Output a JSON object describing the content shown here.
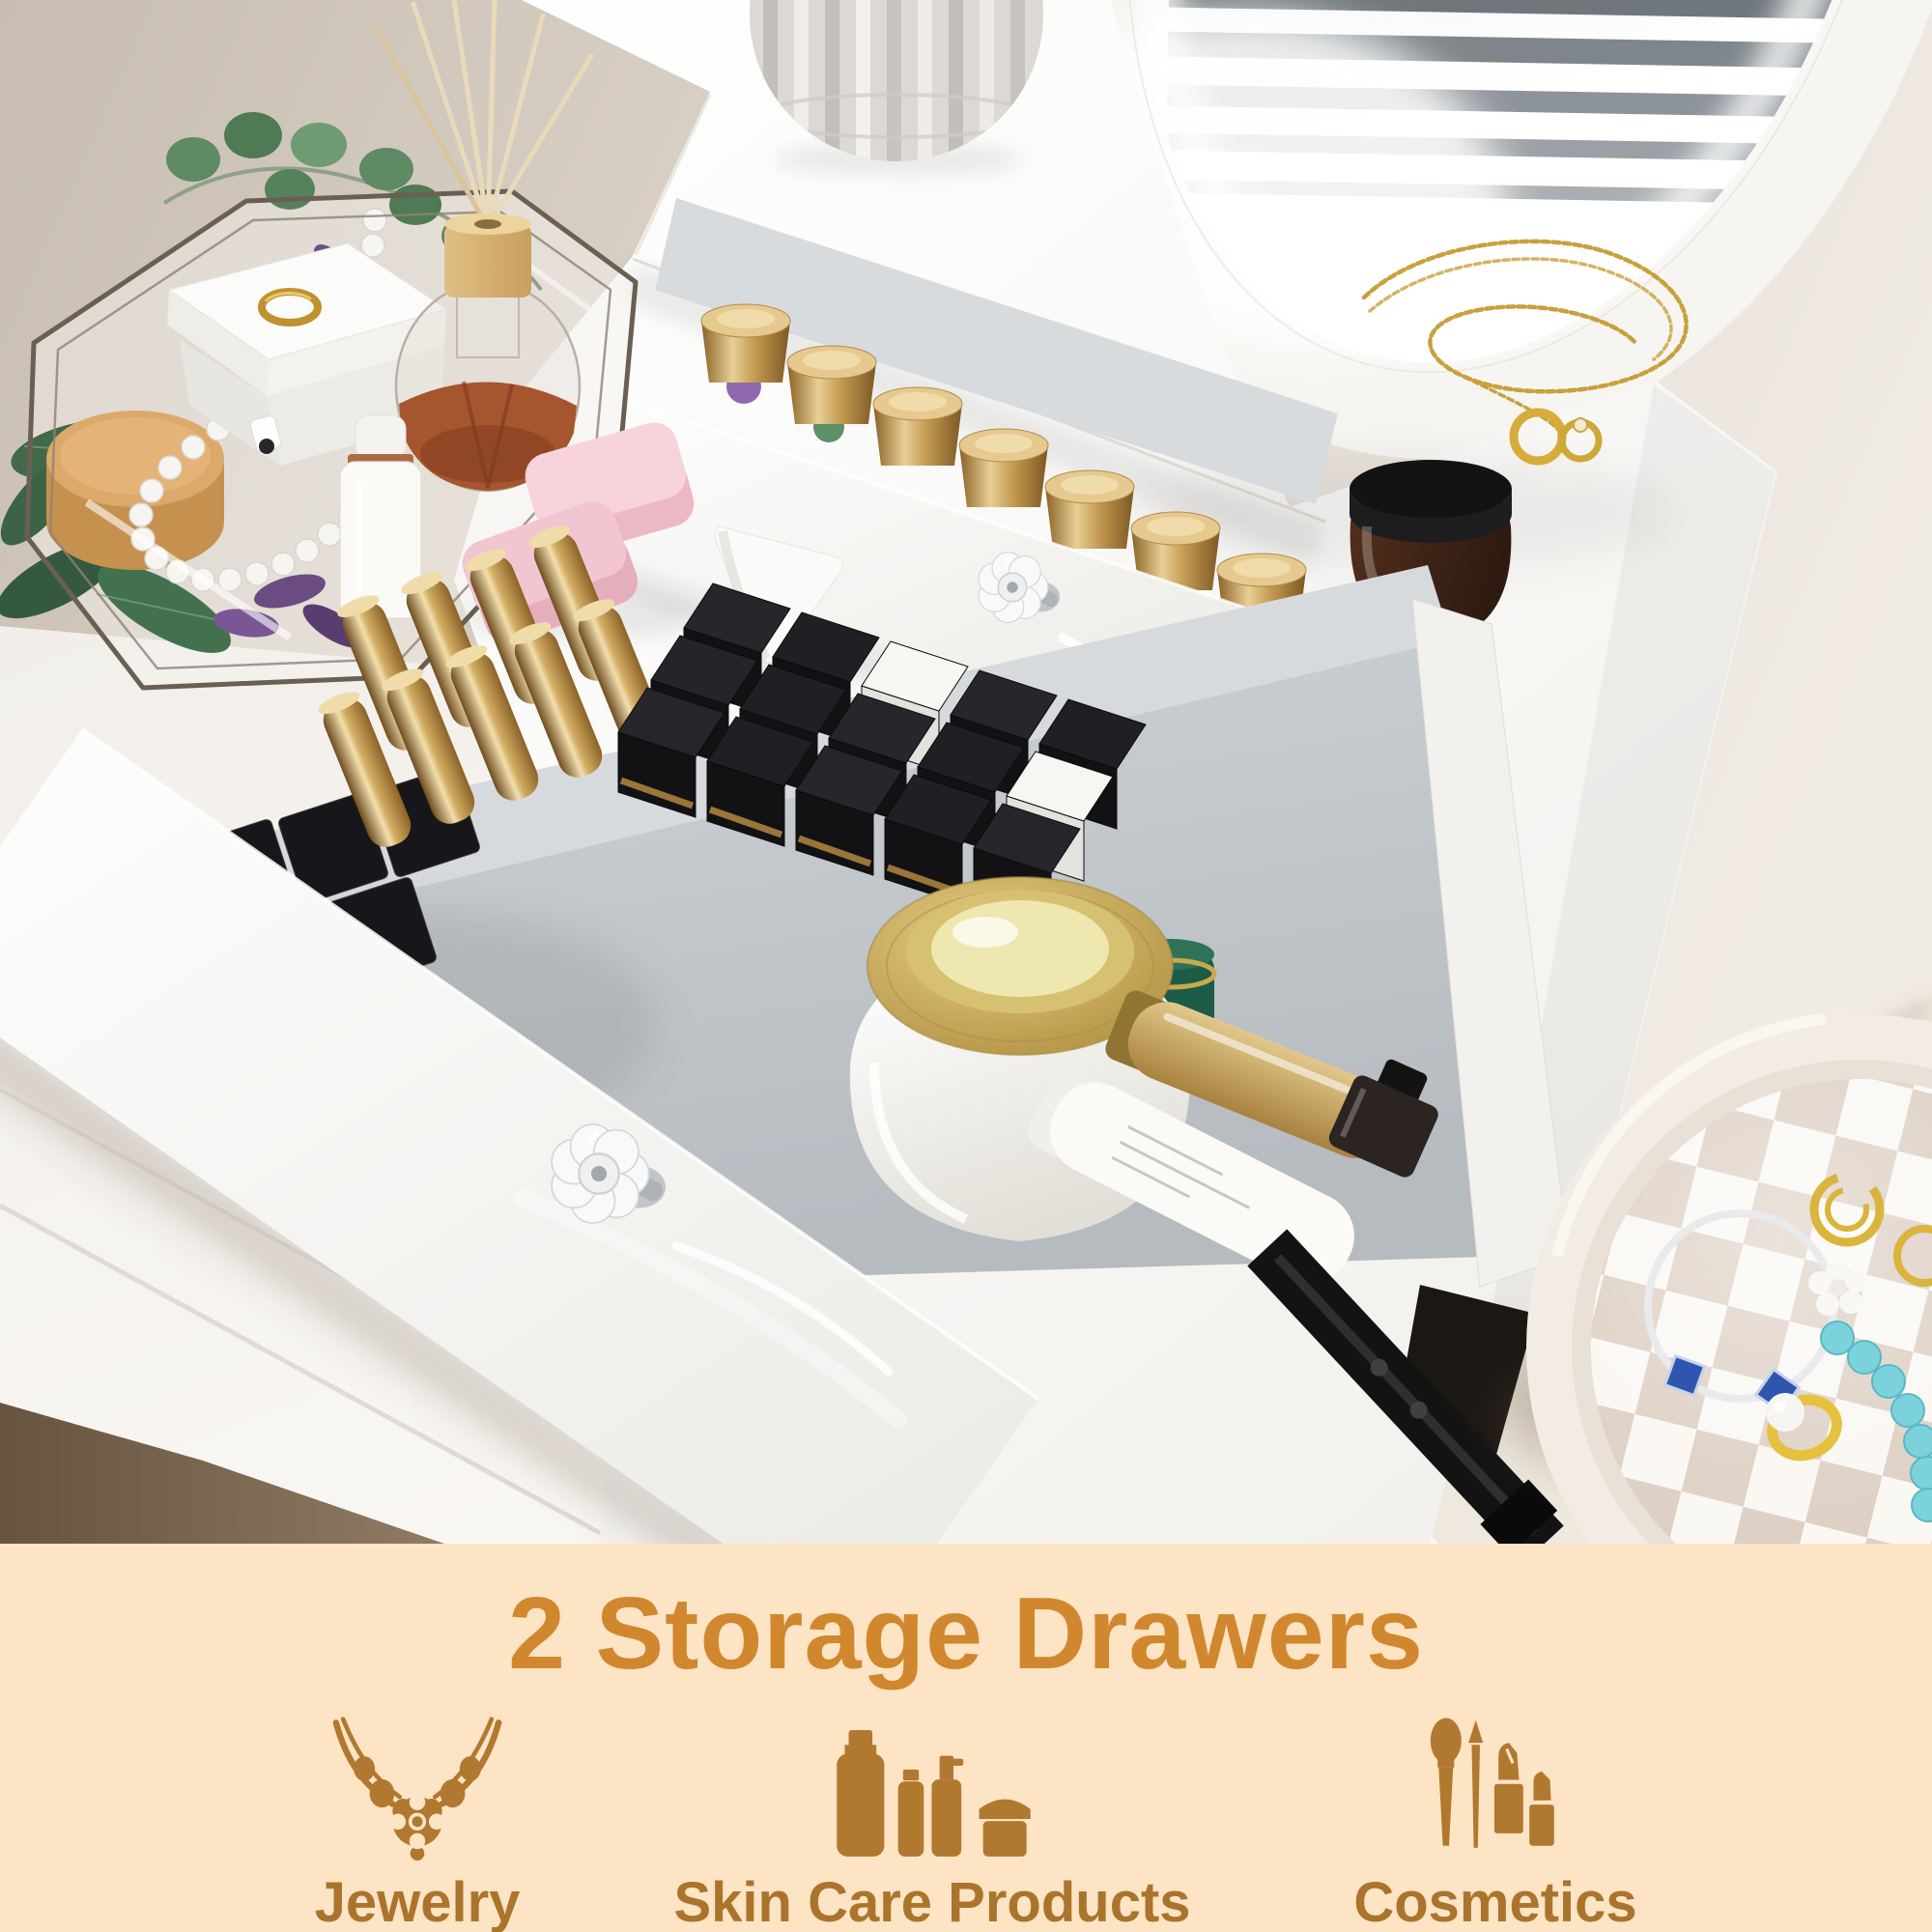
{
  "photo": {
    "alt": "White two-drawer tabletop vanity organizer with both drawers pulled open showing nail polishes, gold lipsticks, black makeup boxes, cream jars and skincare bottles; lighted oval mirror behind; gold necklace and rings on top; glass tray with white jewelry box, bead necklace and reed diffuser at left; pink soaps and makeup sponge; round checkered tray with bracelets and rings at lower right"
  },
  "banner": {
    "background_color": "#FCE4C4",
    "heading": "2 Storage Drawers",
    "heading_color": "#D1872E",
    "icon_color": "#B1782F",
    "label_color": "#AA742C",
    "items": [
      {
        "label": "Jewelry",
        "icon": "necklace-icon"
      },
      {
        "label": "Skin Care Products",
        "icon": "skincare-bottles-icon"
      },
      {
        "label": "Cosmetics",
        "icon": "cosmetics-brushes-lipstick-icon"
      }
    ]
  }
}
